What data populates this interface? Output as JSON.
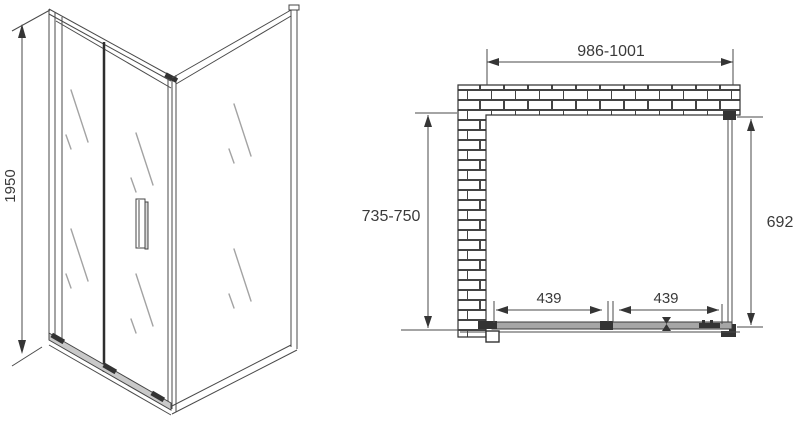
{
  "drawing": {
    "title": "shower-enclosure-technical-drawing",
    "iso_view": {
      "height_label": "1950"
    },
    "plan_view": {
      "width_label": "986-1001",
      "depth_label": "735-750",
      "side_panel_label": "692",
      "door_sections": [
        "439",
        "439"
      ]
    },
    "colors": {
      "line": "#4a4a4a",
      "dark_hardware": "#333333",
      "glass_shine": "#a3a3a3",
      "track_fill": "#a6a6a6",
      "background": "#ffffff",
      "text": "#3a3a3a"
    }
  }
}
